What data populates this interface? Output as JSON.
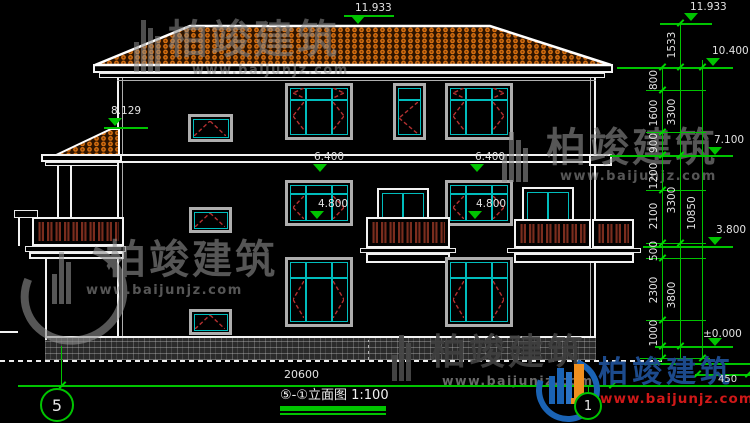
{
  "drawing": {
    "title": "⑤-①立面图 1:100",
    "axis_bubbles": {
      "left": "5",
      "right": "1"
    },
    "bottom_width": "20600",
    "ground_offset": "450"
  },
  "levels": {
    "ridge_top": "11.933",
    "wing_roof": "8.129",
    "floor3_head_left": "6.400",
    "floor3_head_right": "6.400",
    "floor2_head_left": "4.800",
    "floor2_head_right": "4.800"
  },
  "right_dimensions": {
    "level_marks": [
      "11.933",
      "10.400",
      "7.100",
      "3.800",
      "±0.000"
    ],
    "segments_inner": [
      "800",
      "1600",
      "900",
      "1200",
      "2100",
      "500",
      "2300",
      "1000"
    ],
    "segments_middle": [
      "1533",
      "3300",
      "3300",
      "3800"
    ],
    "total": "10850"
  },
  "watermark": {
    "brand": "柏竣建筑",
    "url": "www.baijunjz.com"
  },
  "colors": {
    "background": "#000000",
    "line_white": "#f2f2f2",
    "dimension_green": "#00c400",
    "frame_cyan": "#00bdbd",
    "opening_red": "#b23030",
    "roof_tile_orange": "#d66f10",
    "logo_blue": "#1a63b5",
    "logo_orange": "#ef8f1f",
    "logo_url_red": "#d01818"
  }
}
